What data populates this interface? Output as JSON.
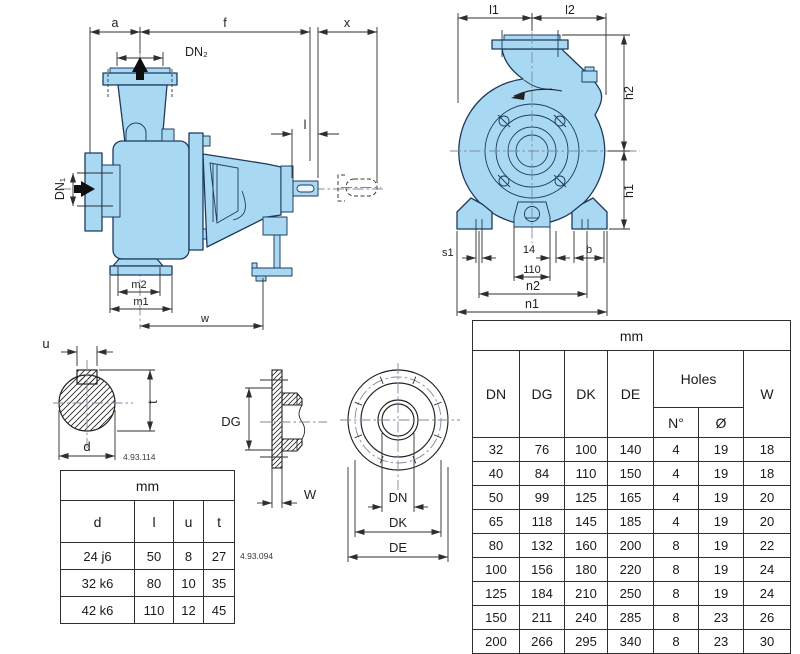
{
  "side_view": {
    "a": "a",
    "f": "f",
    "x": "x",
    "dn2": "DN₂",
    "dn1": "DN₁",
    "l": "l",
    "m2": "m2",
    "m1": "m1",
    "w": "w"
  },
  "front_view": {
    "l1": "l1",
    "l2": "l2",
    "h2": "h2",
    "h1": "h1",
    "s1": "s1",
    "d14": "14",
    "d110": "110",
    "b": "b",
    "n2": "n2",
    "n1": "n1"
  },
  "shaft_end": {
    "u": "u",
    "t": "t",
    "d": "d",
    "code": "4.93.114"
  },
  "counterflange_section": {
    "dg": "DG",
    "w": "W",
    "code": "4.93.094"
  },
  "counterflange_front": {
    "dn": "DN",
    "dk": "DK",
    "de": "DE"
  },
  "shaft_table": {
    "unit": "mm",
    "columns": [
      "d",
      "l",
      "u",
      "t"
    ],
    "rows": [
      [
        "24 j6",
        "50",
        "8",
        "27"
      ],
      [
        "32 k6",
        "80",
        "10",
        "35"
      ],
      [
        "42 k6",
        "110",
        "12",
        "45"
      ]
    ]
  },
  "flange_table": {
    "unit": "mm",
    "headers": {
      "dn": "DN",
      "dg": "DG",
      "dk": "DK",
      "de": "DE",
      "holes": "Holes",
      "n": "N°",
      "diameter": "Ø",
      "w": "W"
    },
    "rows": [
      [
        "32",
        "76",
        "100",
        "140",
        "4",
        "19",
        "18"
      ],
      [
        "40",
        "84",
        "110",
        "150",
        "4",
        "19",
        "18"
      ],
      [
        "50",
        "99",
        "125",
        "165",
        "4",
        "19",
        "20"
      ],
      [
        "65",
        "118",
        "145",
        "185",
        "4",
        "19",
        "20"
      ],
      [
        "80",
        "132",
        "160",
        "200",
        "8",
        "19",
        "22"
      ],
      [
        "100",
        "156",
        "180",
        "220",
        "8",
        "19",
        "24"
      ],
      [
        "125",
        "184",
        "210",
        "250",
        "8",
        "19",
        "24"
      ],
      [
        "150",
        "211",
        "240",
        "285",
        "8",
        "23",
        "26"
      ],
      [
        "200",
        "266",
        "295",
        "340",
        "8",
        "23",
        "30"
      ]
    ]
  },
  "colors": {
    "pump_fill": "#a9d9f2",
    "pump_outline": "#1c3a5e",
    "dimension_line": "#2e2e2e"
  }
}
